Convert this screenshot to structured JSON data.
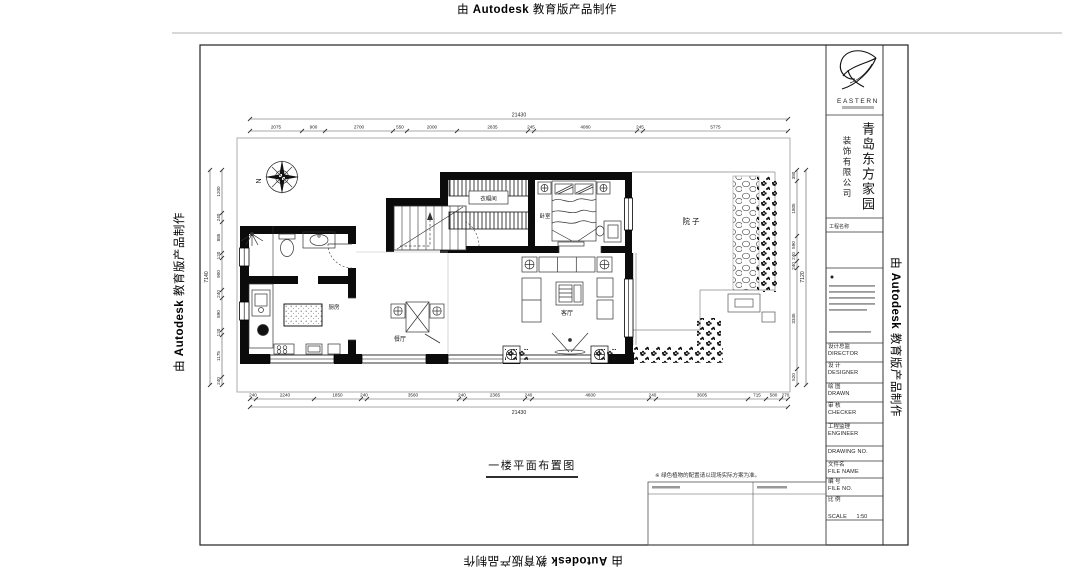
{
  "stamp": {
    "pre": "由",
    "brand": "Autodesk",
    "post": "教育版产品制作"
  },
  "title_block": {
    "logo_text": "EASTERN",
    "company_main": "青岛东方家园",
    "company_sub": "装饰有限公司",
    "project_label": "工程名称",
    "fields": [
      {
        "cn": "设计总监",
        "en": "DIRECTOR"
      },
      {
        "cn": "设 计",
        "en": "DESIGNER"
      },
      {
        "cn": "绘 图",
        "en": "DRAWN"
      },
      {
        "cn": "审 核",
        "en": "CHECKER"
      },
      {
        "cn": "工程监理",
        "en": "ENGINEER"
      },
      {
        "cn": "",
        "en": "DRAWING  NO."
      },
      {
        "cn": "文件名",
        "en": "FILE NAME"
      },
      {
        "cn": "编 号",
        "en": "FILE NO."
      },
      {
        "cn": "比 例",
        "en": "SCALE"
      }
    ],
    "scale_value": "1:50"
  },
  "plan": {
    "drawing_title": "一楼平面布置图",
    "note": "※ 绿色植物的配置请以现场实际方案为准。",
    "compass_north": "N",
    "rooms": {
      "closet": "衣帽间",
      "bedroom": "卧室",
      "courtyard": "院子",
      "living": "客厅",
      "dining": "餐厅",
      "kitchen": "厨房"
    },
    "dims": {
      "top": {
        "total": "21430",
        "values": [
          "2075",
          "900",
          "2700",
          "550",
          "2000",
          "2835",
          "245",
          "4080",
          "245",
          "5775"
        ]
      },
      "bottom": {
        "total": "21430",
        "values": [
          "240",
          "2240",
          "1850",
          "240",
          "3560",
          "240",
          "2365",
          "240",
          "4600",
          "240",
          "3605",
          "715",
          "580",
          "270"
        ]
      },
      "left": {
        "total": "7140",
        "values": [
          "1200",
          "240",
          "885",
          "120",
          "900",
          "240",
          "890",
          "120",
          "1175",
          "240"
        ]
      },
      "right": {
        "total": "7120",
        "values": [
          "380",
          "1805",
          "590",
          "240",
          "240",
          "3345",
          "520"
        ]
      }
    }
  }
}
